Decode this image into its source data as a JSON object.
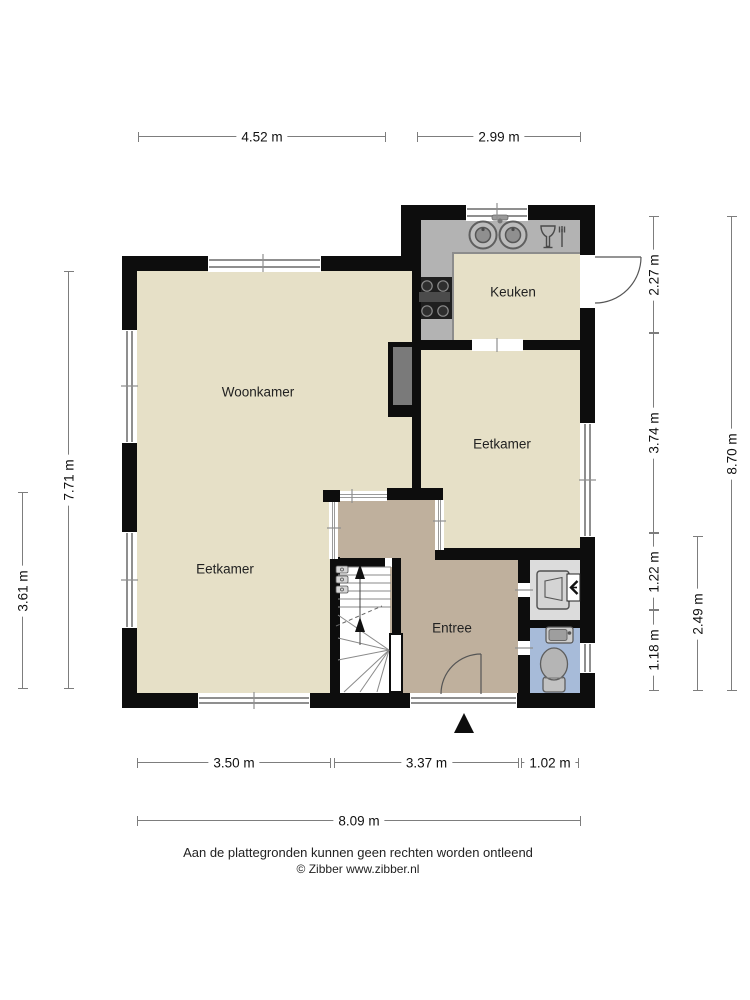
{
  "rooms": {
    "woonkamer": "Woonkamer",
    "keuken": "Keuken",
    "eetkamer_right": "Eetkamer",
    "eetkamer_left": "Eetkamer",
    "entree": "Entree"
  },
  "dimensions": {
    "top": {
      "left_section": "4.52 m",
      "right_section": "2.99 m"
    },
    "bottom": {
      "seg1": "3.50 m",
      "seg2": "3.37 m",
      "seg3": "1.02 m",
      "total": "8.09 m"
    },
    "left": {
      "total": "7.71 m",
      "lower": "3.61 m"
    },
    "right": {
      "seg1": "2.27 m",
      "seg2": "3.74 m",
      "seg3": "1.22 m",
      "seg4": "1.18 m",
      "lower_sub": "2.49 m",
      "total": "8.70 m"
    }
  },
  "footer": {
    "disclaimer": "Aan de plattegronden kunnen geen rechten worden ontleend",
    "copyright": "© Zibber www.zibber.nl"
  },
  "icons": {
    "kitchen_sink": "double-sink",
    "dishwasher": "glass-fork-symbol",
    "stove": "four-burner-hob",
    "boiler": "boiler-unit",
    "ventilation": "mechanical-ventilation-arrow",
    "toilet": "toilet-top-view",
    "hand_basin": "hand-basin",
    "staircase": "staircase-up-arrows",
    "entrance": "entrance-triangle"
  },
  "colors": {
    "wall": "#0d0d0d",
    "room_beige": "#e6e0c7",
    "hall_taupe": "#bfb09d",
    "toilet_blue": "#a7bbd9",
    "utility_gray": "#dcdcdc",
    "counter_gray": "#b3b3b3",
    "chimney_gray": "#7a7a7a",
    "dimension_line": "#7d7d7d"
  }
}
